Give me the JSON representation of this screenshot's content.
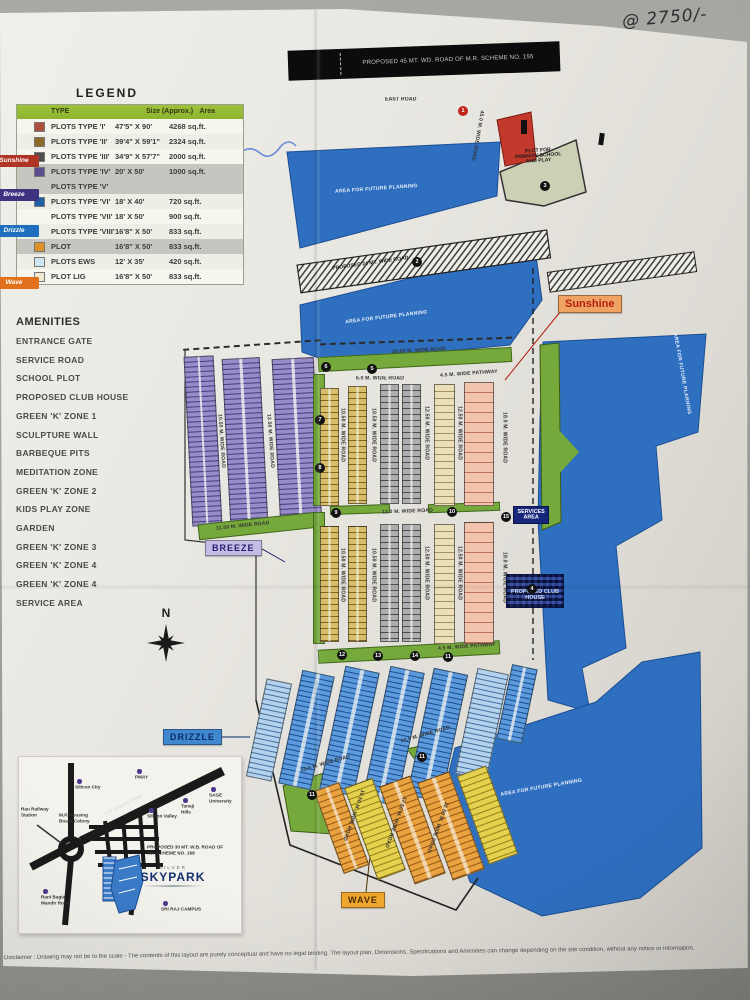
{
  "annotation": {
    "price_note": "@ 2750/-"
  },
  "legend": {
    "title": "LEGEND",
    "columns": {
      "name": "NAME",
      "type": "TYPE",
      "size": "Size (Approx.)",
      "area": "Area"
    },
    "rows": [
      {
        "swatch_css": "background:#b0503c",
        "type": "PLOTS TYPE 'I'",
        "size": "47'5\" X 90'",
        "area": "4268 sq.ft.",
        "band": "w"
      },
      {
        "swatch_css": "background:#8a6a28",
        "type": "PLOTS TYPE 'II'",
        "size": "39'4\" X 59'1\"",
        "area": "2324 sq.ft.",
        "band": "w"
      },
      {
        "swatch_css": "background:#4f4f4f",
        "type": "PLOTS TYPE 'III'",
        "size": "34'9\" X 57'7\"",
        "area": "2000 sq.ft.",
        "band": "w"
      },
      {
        "swatch_css": "background:#5c4e91",
        "type": "PLOTS TYPE 'IV'",
        "size": "20' X 50'",
        "area": "1000 sq.ft.",
        "band": "g"
      },
      {
        "swatch_css": "visibility:hidden",
        "type": "PLOTS TYPE 'V'",
        "size": "",
        "area": "",
        "band": "g"
      },
      {
        "swatch_css": "background:#1f5fa8",
        "type": "PLOTS TYPE 'VI'",
        "size": "18' X 40'",
        "area": "720 sq.ft.",
        "band": "w"
      },
      {
        "swatch_css": "visibility:hidden",
        "type": "PLOTS TYPE 'VII'",
        "size": "18' X 50'",
        "area": "900 sq.ft.",
        "band": "w"
      },
      {
        "swatch_css": "visibility:hidden",
        "type": "PLOTS TYPE 'VIII'",
        "size": "16'8\" X 50'",
        "area": "833 sq.ft.",
        "band": "w"
      },
      {
        "swatch_css": "background:#de9126",
        "type": "PLOT",
        "size": "16'8\" X 50'",
        "area": "833 sq.ft.",
        "band": "g"
      },
      {
        "swatch_css": "background:#cfe6f2",
        "type": "PLOTS EWS",
        "size": "12' X 35'",
        "area": "420 sq.ft.",
        "band": "w"
      },
      {
        "swatch_css": "background:#f0ead0",
        "type": "PLOT LIG",
        "size": "16'8\" X 50'",
        "area": "833 sq.ft.",
        "band": "w"
      }
    ],
    "zone_tags": [
      {
        "label": "Sunshine",
        "s": "top:50px;background:#b03424"
      },
      {
        "label": "Breeze",
        "s": "top:84px;background:#3d3380"
      },
      {
        "label": "Drizzle",
        "s": "top:120px;background:#1f6fbf"
      },
      {
        "label": "Wave",
        "s": "top:172px;background:#e2711d"
      }
    ]
  },
  "amenities": {
    "title": "AMENITIES",
    "items": [
      "ENTRANCE GATE",
      "SERVICE ROAD",
      "SCHOOL PLOT",
      "PROPOSED CLUB HOUSE",
      "GREEN 'K' ZONE 1",
      "SCULPTURE WALL",
      "BARBEQUE PITS",
      "MEDITATION ZONE",
      "GREEN 'K' ZONE 2",
      "KIDS PLAY ZONE",
      "GARDEN",
      "GREEN 'K' ZONE 3",
      "GREEN 'K' ZONE 4",
      "GREEN 'K' ZONE 4",
      "SERVICE AREA"
    ]
  },
  "map": {
    "banner": "PROPOSED 45 MT. WD. ROAD OF M.R. SCHEME NO. 155",
    "compass_n": "N",
    "labels": [
      {
        "t": "EAST ROAD",
        "s": "left:385px;top:97px",
        "c": "rl"
      },
      {
        "t": "45.0 M. WIDE ROAD",
        "s": "left:474px;top:110px;transform:rotate(10deg)",
        "c": "rl v"
      },
      {
        "t": "AREA FOR FUTURE PLANNING",
        "s": "left:335px;top:186px;transform:rotate(-4deg)",
        "c": "wl"
      },
      {
        "t": "AREA FOR FUTURE PLANNING",
        "s": "left:345px;top:314px;transform:rotate(-7deg)",
        "c": "wl"
      },
      {
        "t": "AREA FOR FUTURE PLANNING",
        "s": "left:634px;top:378px;transform:rotate(80deg)",
        "c": "wl"
      },
      {
        "t": "AREA FOR FUTURE PLANNING",
        "s": "left:500px;top:784px;transform:rotate(-10deg)",
        "c": "wl"
      },
      {
        "t": "PLOT FOR\nPRIMARY SCHOOL\nAND PLAY",
        "s": "left:512px;top:148px;width:62px;transform:rotate(-4deg)",
        "c": "bl c"
      },
      {
        "t": "PROPOSED 24 MT. WIDE ROAD",
        "s": "left:332px;top:260px;transform:rotate(-8deg)",
        "c": "bl"
      },
      {
        "t": "16.50 M. WIDE ROAD",
        "s": "left:392px;top:348px;transform:rotate(-3deg)",
        "c": "rl"
      },
      {
        "t": "6.0 M. WIDE ROAD",
        "s": "left:356px;top:376px",
        "c": "rl"
      },
      {
        "t": "4.5 M. WIDE PATHWAY",
        "s": "left:440px;top:371px;transform:rotate(-4deg)",
        "c": "rl"
      },
      {
        "t": "10.50 M. WIDE ROAD",
        "s": "left:219px;top:414px;transform:rotate(-4deg)",
        "c": "rl v"
      },
      {
        "t": "12.50 M. WIDE ROAD",
        "s": "left:268px;top:414px;transform:rotate(-4deg)",
        "c": "rl v"
      },
      {
        "t": "11.50 M. WIDE ROAD",
        "s": "left:216px;top:523px;transform:rotate(-6deg)",
        "c": "rl"
      },
      {
        "t": "10.50 M. WIDE ROAD",
        "s": "left:340px;top:408px",
        "c": "rl v"
      },
      {
        "t": "10.50 M. WIDE ROAD",
        "s": "left:371px;top:408px",
        "c": "rl v"
      },
      {
        "t": "12.50 M. WIDE ROAD",
        "s": "left:424px;top:406px",
        "c": "rl v"
      },
      {
        "t": "12.50 M. WIDE ROAD",
        "s": "left:457px;top:406px",
        "c": "rl v"
      },
      {
        "t": "18.0 M. WIDE ROAD",
        "s": "left:502px;top:412px",
        "c": "rl v"
      },
      {
        "t": "12.0 M. WIDE ROAD",
        "s": "left:382px;top:509px;transform:rotate(-2deg)",
        "c": "rl"
      },
      {
        "t": "10.50 M. WIDE ROAD",
        "s": "left:340px;top:548px",
        "c": "rl v"
      },
      {
        "t": "10.50 M. WIDE ROAD",
        "s": "left:371px;top:548px",
        "c": "rl v"
      },
      {
        "t": "12.50 M. WIDE ROAD",
        "s": "left:424px;top:546px",
        "c": "rl v"
      },
      {
        "t": "12.50 M. WIDE ROAD",
        "s": "left:457px;top:546px",
        "c": "rl v"
      },
      {
        "t": "18.0 M. WIDE ROAD",
        "s": "left:502px;top:552px",
        "c": "rl v"
      },
      {
        "t": "4.5 M. WIDE PATHWAY",
        "s": "left:438px;top:644px;transform:rotate(-4deg)",
        "c": "rl"
      },
      {
        "t": "10.0 M. WIDE ROAD",
        "s": "left:400px;top:731px;transform:rotate(-16deg)",
        "c": "rl"
      },
      {
        "t": "12.5 M. WIDE ROAD",
        "s": "left:300px;top:760px;transform:rotate(-16deg)",
        "c": "rl"
      },
      {
        "t": "10.50 M. WIDE ROAD",
        "s": "left:349px;top:788px;transform:rotate(20deg)",
        "c": "rl v"
      },
      {
        "t": "12.50 M. WIDE ROAD",
        "s": "left:391px;top:795px;transform:rotate(20deg)",
        "c": "rl v"
      },
      {
        "t": "12.50 M. WIDE ROAD",
        "s": "left:433px;top:800px;transform:rotate(20deg)",
        "c": "rl v"
      },
      {
        "t": "SERVICES\nAREA",
        "s": "left:511px;top:505px",
        "c": "sv"
      },
      {
        "t": "PROPOSED CLUB HOUSE",
        "s": "left:506px;top:574px",
        "c": "club"
      }
    ],
    "callouts": [
      {
        "t": "Sunshine",
        "s": "left:558px;top:295px",
        "c": "co-sunshine"
      },
      {
        "t": "BREEZE",
        "s": "left:205px;top:540px",
        "c": "co-breeze"
      },
      {
        "t": "DRIZZLE",
        "s": "left:163px;top:729px",
        "c": "co-drizzle"
      },
      {
        "t": "WAVE",
        "s": "left:341px;top:892px",
        "c": "co-wave"
      }
    ],
    "markers": [
      {
        "n": "1",
        "s": "left:463px;top:111px",
        "v": "red"
      },
      {
        "n": "2",
        "s": "left:417px;top:262px"
      },
      {
        "n": "3",
        "s": "left:545px;top:186px"
      },
      {
        "n": "4",
        "s": "left:532px;top:589px"
      },
      {
        "n": "6",
        "s": "left:326px;top:367px"
      },
      {
        "n": "5",
        "s": "left:372px;top:369px"
      },
      {
        "n": "7",
        "s": "left:320px;top:420px"
      },
      {
        "n": "8",
        "s": "left:320px;top:468px"
      },
      {
        "n": "9",
        "s": "left:336px;top:513px"
      },
      {
        "n": "10",
        "s": "left:452px;top:512px"
      },
      {
        "n": "15",
        "s": "left:506px;top:517px"
      },
      {
        "n": "12",
        "s": "left:342px;top:655px"
      },
      {
        "n": "13",
        "s": "left:378px;top:656px"
      },
      {
        "n": "14",
        "s": "left:415px;top:656px"
      },
      {
        "n": "11",
        "s": "left:448px;top:657px"
      },
      {
        "n": "11",
        "s": "left:422px;top:757px"
      },
      {
        "n": "11",
        "s": "left:312px;top:795px"
      }
    ]
  },
  "locmap": {
    "logo_top": "SILVER",
    "logo": "SKYPARK",
    "labels": [
      {
        "t": "Silicon City",
        "s": "left:56px;top:28px",
        "ds": "display:block"
      },
      {
        "t": "PMAY",
        "s": "left:116px;top:18px",
        "ds": "display:block"
      },
      {
        "t": "Silicon Valley",
        "s": "left:128px;top:57px",
        "ds": "display:block"
      },
      {
        "t": "Tanaji\nHills",
        "s": "left:162px;top:47px",
        "ds": "display:block"
      },
      {
        "t": "SAGE\nUniversity",
        "s": "left:190px;top:36px",
        "ds": "display:block"
      },
      {
        "t": "M.P. Housing\nBoard Colony",
        "s": "left:40px;top:56px"
      },
      {
        "t": "Rau Railway\nStation",
        "s": "left:2px;top:50px"
      },
      {
        "t": "Rani Bagia\nMandir Road",
        "s": "left:22px;top:138px",
        "ds": "display:block"
      },
      {
        "t": "SRI RAJ CAMPUS",
        "s": "left:142px;top:150px",
        "ds": "display:block"
      },
      {
        "t": "PROPOSED 30 MT. W.B. ROAD OF\nRW SCHEME NO. 169",
        "s": "left:128px;top:88px"
      },
      {
        "t": "A.B. Bypass Road",
        "s": "left:84px;top:44px;transform:rotate(-27deg)",
        "c": "onroad"
      }
    ]
  },
  "disclaimer": "Disclaimer : Drawing may not be to the scale - The contents of this layout are purely conceptual and have no legal binding. The layout plan, Dimensions, Specifications and Amenities can change depending on the site condition, without any notice or information."
}
